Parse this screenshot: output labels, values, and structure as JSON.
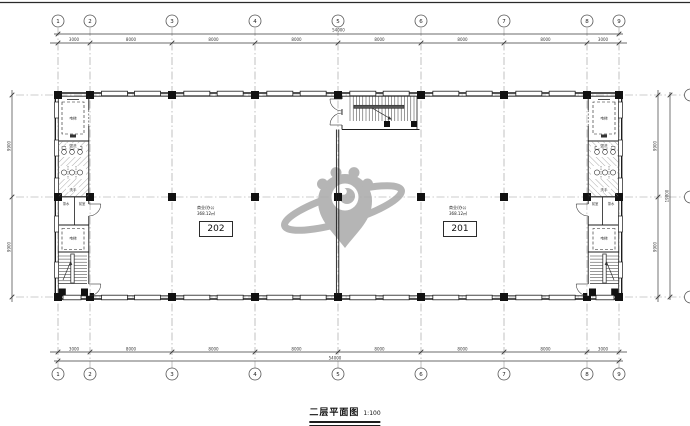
{
  "document": {
    "title": "二层平面图",
    "scale": "1:100"
  },
  "rooms": [
    {
      "number": "202",
      "note_line1": "商业/办公",
      "note_line2": "368.12㎡"
    },
    {
      "number": "201",
      "note_line1": "商业/办公",
      "note_line2": "368.12㎡"
    }
  ],
  "grid": {
    "col_labels": [
      "1",
      "2",
      "3",
      "4",
      "5",
      "6",
      "7",
      "8",
      "9"
    ]
  },
  "dimensions": {
    "top_segments": [
      "3000",
      "8000",
      "8000",
      "8000",
      "8000",
      "8000",
      "8000",
      "3000"
    ],
    "top_overall": "54000",
    "bottom_segments": [
      "3000",
      "8000",
      "8000",
      "8000",
      "8000",
      "8000",
      "8000",
      "3000"
    ],
    "bottom_overall": "54000",
    "left_segments": [
      "9900",
      "9900"
    ],
    "right_segments": [
      "9900",
      "9900"
    ],
    "right_overall": "19800"
  },
  "core_labels": {
    "elevator": "电梯",
    "wash": "盥洗",
    "wc": "洗手",
    "pantry": "茶水",
    "lobby": "前室"
  },
  "watermark": {
    "color": "#ababab"
  },
  "colors": {
    "wall": "#1c1c1c",
    "grid": "#9a9a9a",
    "dim": "#3a3a3a",
    "hatch": "#888888"
  }
}
